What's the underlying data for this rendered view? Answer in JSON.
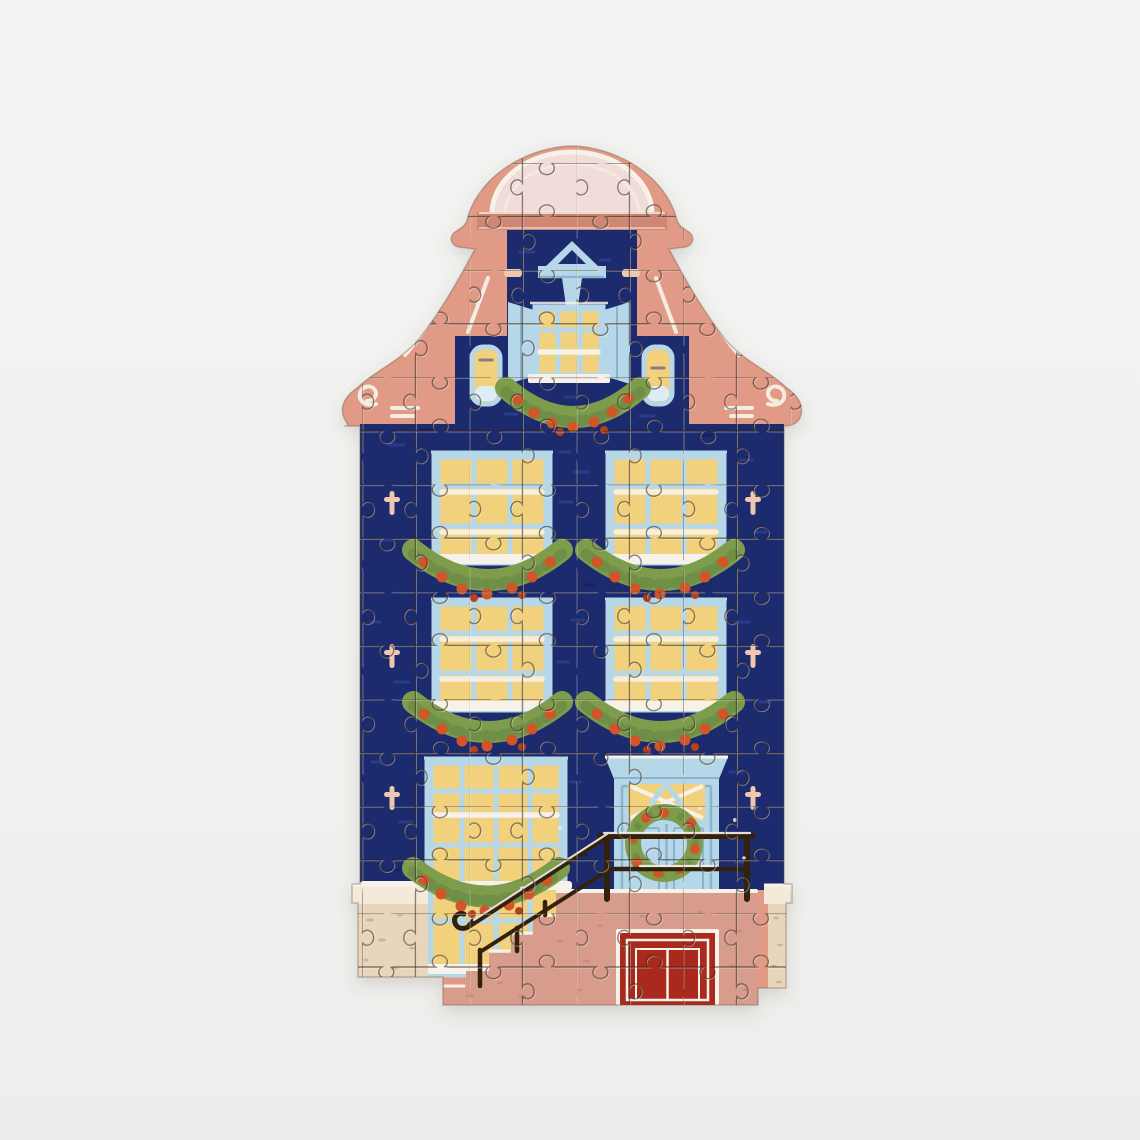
{
  "scene": {
    "type": "product-photo",
    "subject": "completed shaped jigsaw puzzle",
    "motif": "Amsterdam bell-gable canal house decorated for Christmas at night",
    "aria_label": "Completed die-cut jigsaw puzzle shaped like a dark blue Amsterdam canal house with a pink bell gable, glowing yellow windows hung with Christmas garlands, a light blue front door with a wreath, a stair railing over a pink stoop, and a red cellar door, photographed on a plain light grey background",
    "background_color": "#f1f1ef",
    "palette": {
      "bg": "#f1f1ef",
      "navy": "#1e2a6e",
      "navy_brush": "#36469b",
      "navy_deep": "#161f55",
      "salmon": "#e09a86",
      "salmon_dark": "#cf8672",
      "dome_pink": "#f2dcda",
      "white_paint": "#f7f2e9",
      "light_blue": "#b6d7e8",
      "blue_shade": "#8ab3cd",
      "pale_blue": "#dcedf6",
      "window_yellow": "#f2d17c",
      "garland_green": "#7d9d4e",
      "garland_dark": "#5f813c",
      "berry": "#d25429",
      "berry_dark": "#b8401f",
      "stoop_pink": "#d89c8d",
      "stoop_fleck": "#c08070",
      "beige": "#e8d5bb",
      "beige_light": "#f3ead9",
      "beige_fleck": "#b99b72",
      "cellar_red": "#a9291d",
      "rail": "#32210f",
      "anchor_pink": "#efc6ae",
      "cut_line": "rgba(48,33,18,0.55)",
      "cut_hilite": "rgba(255,255,255,0.40)"
    },
    "details": {
      "gable_style": "bell gable with scroll volutes and domed crown",
      "floors": 3,
      "large_windows": 5,
      "attic_window": 1,
      "small_side_windows": 2,
      "garland_swags": 6,
      "door_wreaths": 1,
      "hoist_beam": true,
      "wall_anchors": 6,
      "stair_railing": true,
      "cellar_door": true,
      "snow_on_ledges": true,
      "approx_piece_columns": 8,
      "approx_piece_rows": 16
    }
  }
}
